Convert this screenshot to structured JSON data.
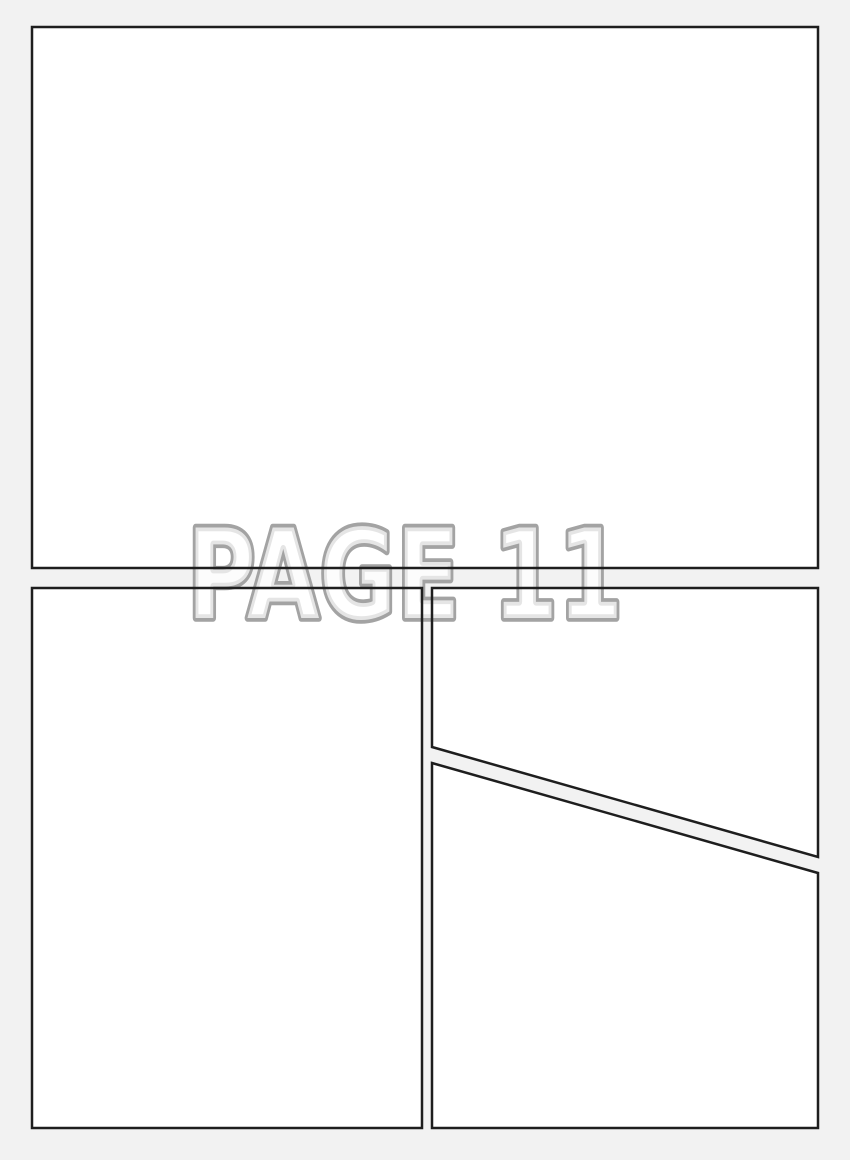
{
  "watermark": {
    "text": "PAGE 11"
  },
  "colors": {
    "background": "#f2f2f2",
    "panel_fill": "#ffffff",
    "panel_border": "#1e1e1e",
    "watermark_outline": "#a3a3a3",
    "watermark_fill": "rgba(255,255,255,0.72)"
  }
}
